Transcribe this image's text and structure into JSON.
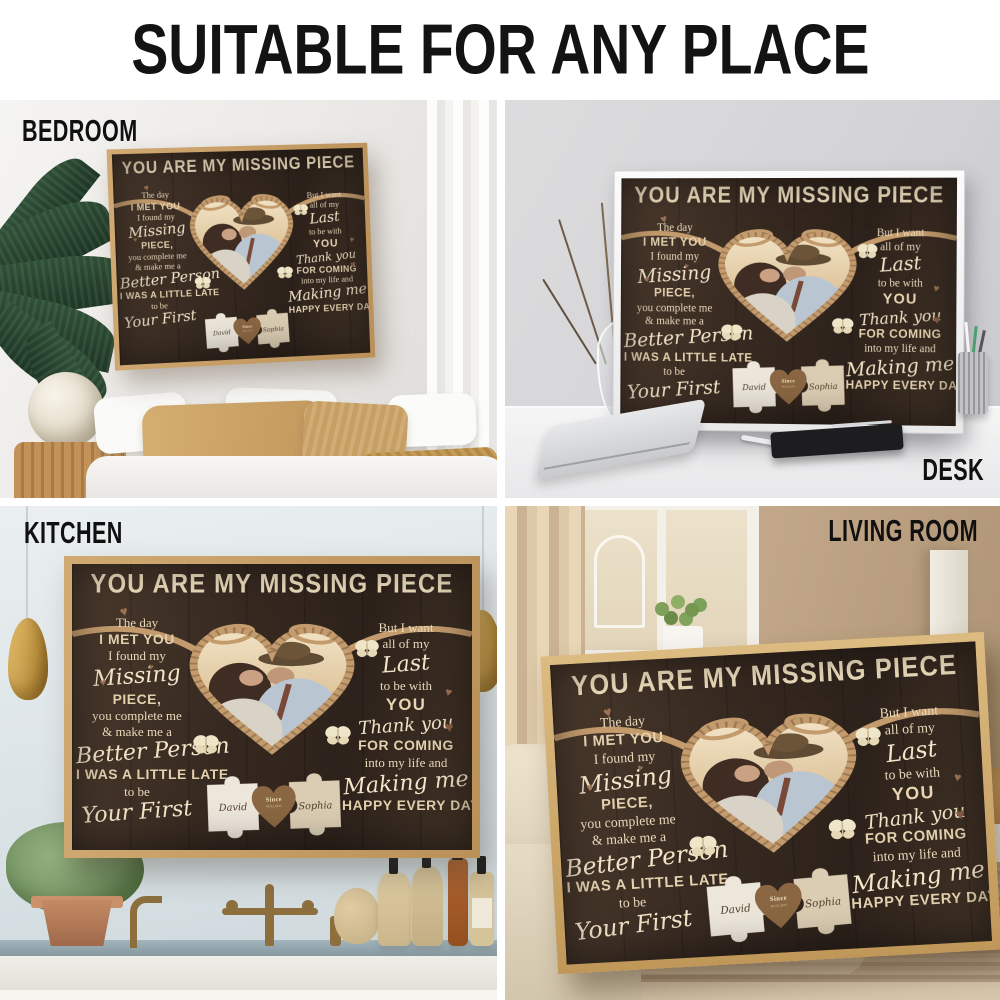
{
  "header": {
    "title": "SUITABLE FOR ANY PLACE"
  },
  "scenes": {
    "bedroom": {
      "label": "BEDROOM"
    },
    "desk": {
      "label": "DESK"
    },
    "kitchen": {
      "label": "KITCHEN"
    },
    "living_room": {
      "label": "LIVING ROOM"
    }
  },
  "poster": {
    "title": "YOU ARE MY MISSING PIECE",
    "left": {
      "l1": "The day",
      "l2": "I MET YOU",
      "l3": "I found my",
      "l4": "Missing",
      "l5": "PIECE,",
      "l6": "you complete me",
      "l7": "& make me a",
      "l8": "Better Person",
      "l9": "I WAS A LITTLE LATE",
      "l10": "to be",
      "l11": "Your First"
    },
    "right": {
      "r1": "But I want",
      "r2": "all of my",
      "r3": "Last",
      "r4": "to be with",
      "r5": "YOU",
      "r6": "Thank you",
      "r7": "FOR COMING",
      "r8": "into my life and",
      "r9": "Making me",
      "r10": "HAPPY EVERY DAY"
    },
    "puzzle": {
      "left_name": "David",
      "right_name": "Sophia",
      "heart_top": "Since",
      "heart_date": "09.02.2015"
    }
  },
  "icons": {
    "heart": "♥"
  },
  "colors": {
    "poster_wood_dark": "#33261d",
    "poster_cream_text": "#ead9bb",
    "rope_tan": "#c39b6c",
    "frame_oak": "#c29a6b",
    "frame_white": "#f4f4f4",
    "puzzle_left": "#ece6db",
    "puzzle_right": "#dbcdb3",
    "puzzle_heart_wood": "#8a6742",
    "label_black": "#101010"
  }
}
